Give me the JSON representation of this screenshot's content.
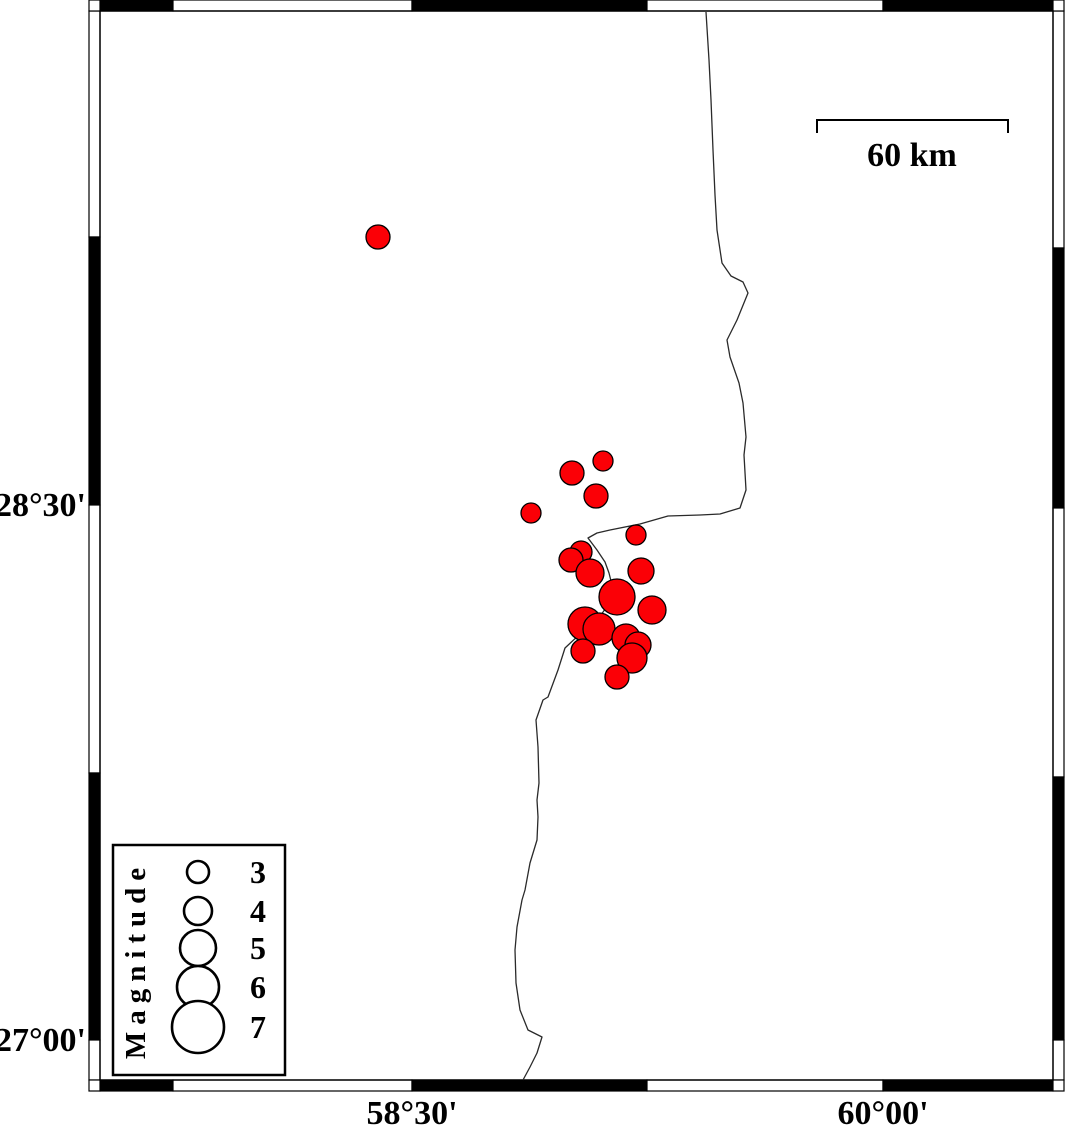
{
  "map": {
    "frame": {
      "inner": {
        "left": 100,
        "top": 11,
        "right": 1053,
        "bottom": 1080
      },
      "band_thickness": 11,
      "top_segments": [
        [
          100,
          173,
          "black"
        ],
        [
          173,
          412,
          "white"
        ],
        [
          412,
          647,
          "black"
        ],
        [
          647,
          883,
          "white"
        ],
        [
          883,
          1053,
          "black"
        ]
      ],
      "bottom_segments": [
        [
          100,
          173,
          "black"
        ],
        [
          173,
          412,
          "white"
        ],
        [
          412,
          647,
          "black"
        ],
        [
          647,
          883,
          "white"
        ],
        [
          883,
          1053,
          "black"
        ]
      ],
      "left_segments": [
        [
          11,
          237,
          "white"
        ],
        [
          237,
          505,
          "black"
        ],
        [
          505,
          773,
          "white"
        ],
        [
          773,
          1040,
          "black"
        ],
        [
          1040,
          1080,
          "white"
        ]
      ],
      "right_segments": [
        [
          11,
          248,
          "white"
        ],
        [
          248,
          508,
          "black"
        ],
        [
          508,
          777,
          "white"
        ],
        [
          777,
          1040,
          "black"
        ],
        [
          1040,
          1080,
          "white"
        ]
      ]
    },
    "labels": {
      "lat": [
        {
          "text": "28°30'",
          "y": 505
        },
        {
          "text": "27°00'",
          "y": 1040
        }
      ],
      "lon": [
        {
          "text": "58°30'",
          "x": 412
        },
        {
          "text": "60°00'",
          "x": 883
        }
      ]
    },
    "scale_bar": {
      "label": "60 km",
      "x1": 817,
      "x2": 1008,
      "y": 120,
      "tick": 13
    },
    "coastline_color": "#2a2a2a",
    "coastline": [
      [
        706,
        12
      ],
      [
        709,
        60
      ],
      [
        711,
        100
      ],
      [
        713,
        150
      ],
      [
        715,
        195
      ],
      [
        717,
        230
      ],
      [
        722,
        263
      ],
      [
        731,
        276
      ],
      [
        743,
        282
      ],
      [
        748,
        293
      ],
      [
        737,
        320
      ],
      [
        727,
        340
      ],
      [
        730,
        357
      ],
      [
        739,
        383
      ],
      [
        743,
        403
      ],
      [
        746,
        437
      ],
      [
        744,
        455
      ],
      [
        746,
        490
      ],
      [
        740,
        508
      ],
      [
        720,
        514
      ],
      [
        700,
        515
      ],
      [
        668,
        516
      ],
      [
        640,
        524
      ],
      [
        610,
        530
      ],
      [
        597,
        533
      ],
      [
        588,
        538
      ],
      [
        597,
        550
      ],
      [
        605,
        562
      ],
      [
        609,
        573
      ],
      [
        612,
        585
      ],
      [
        608,
        605
      ],
      [
        596,
        622
      ],
      [
        580,
        634
      ],
      [
        565,
        648
      ],
      [
        558,
        670
      ],
      [
        548,
        697
      ],
      [
        543,
        700
      ],
      [
        536,
        720
      ],
      [
        538,
        747
      ],
      [
        539,
        783
      ],
      [
        537,
        800
      ],
      [
        538,
        817
      ],
      [
        537,
        840
      ],
      [
        530,
        863
      ],
      [
        525,
        890
      ],
      [
        522,
        900
      ],
      [
        517,
        927
      ],
      [
        515,
        950
      ],
      [
        516,
        983
      ],
      [
        520,
        1010
      ],
      [
        528,
        1030
      ],
      [
        542,
        1037
      ],
      [
        537,
        1053
      ],
      [
        530,
        1067
      ],
      [
        523,
        1080
      ]
    ],
    "marker_style": {
      "fill": "#fb0006",
      "stroke": "#000000"
    },
    "earthquakes": [
      {
        "x": 378,
        "y": 237,
        "r": 12
      },
      {
        "x": 603,
        "y": 461,
        "r": 10
      },
      {
        "x": 572,
        "y": 473,
        "r": 12
      },
      {
        "x": 596,
        "y": 496,
        "r": 12
      },
      {
        "x": 531,
        "y": 513,
        "r": 10
      },
      {
        "x": 636,
        "y": 535,
        "r": 10
      },
      {
        "x": 581,
        "y": 552,
        "r": 11
      },
      {
        "x": 571,
        "y": 560,
        "r": 12
      },
      {
        "x": 590,
        "y": 573,
        "r": 14
      },
      {
        "x": 641,
        "y": 571,
        "r": 13
      },
      {
        "x": 617,
        "y": 597,
        "r": 18
      },
      {
        "x": 652,
        "y": 610,
        "r": 14
      },
      {
        "x": 585,
        "y": 624,
        "r": 17
      },
      {
        "x": 599,
        "y": 629,
        "r": 16
      },
      {
        "x": 626,
        "y": 638,
        "r": 14
      },
      {
        "x": 638,
        "y": 645,
        "r": 13
      },
      {
        "x": 583,
        "y": 651,
        "r": 12
      },
      {
        "x": 632,
        "y": 658,
        "r": 15
      },
      {
        "x": 617,
        "y": 677,
        "r": 12
      }
    ]
  },
  "legend": {
    "title": "Magnitude",
    "box": {
      "left": 113,
      "top": 845,
      "right": 285,
      "bottom": 1075
    },
    "circle_cx": 198,
    "label_x": 258,
    "entries": [
      {
        "label": "3",
        "r": 11,
        "cy": 872
      },
      {
        "label": "4",
        "r": 14,
        "cy": 911
      },
      {
        "label": "5",
        "r": 18,
        "cy": 948
      },
      {
        "label": "6",
        "r": 21,
        "cy": 987
      },
      {
        "label": "7",
        "r": 26,
        "cy": 1027
      }
    ]
  }
}
